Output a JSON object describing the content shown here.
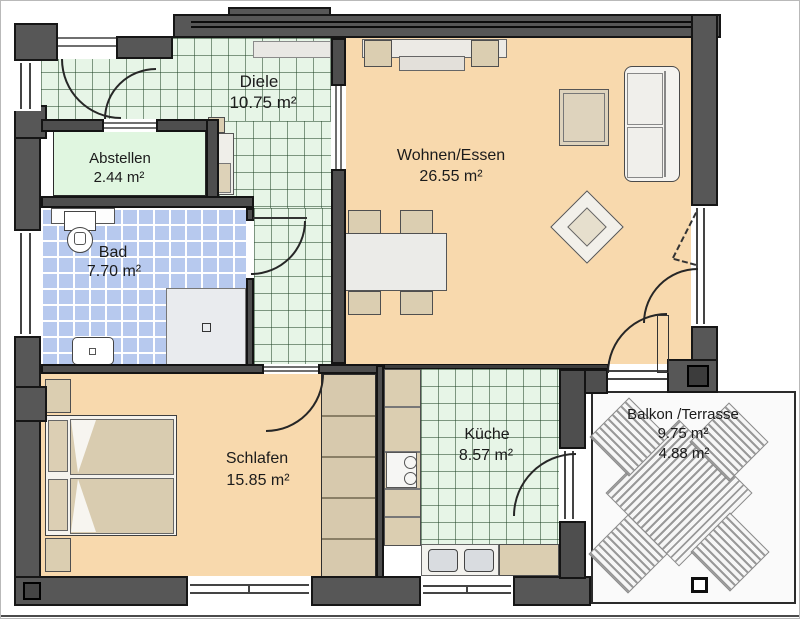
{
  "plan": {
    "rooms": {
      "diele": {
        "name": "Diele",
        "area": "10.75 m²"
      },
      "abstellen": {
        "name": "Abstellen",
        "area": "2.44 m²"
      },
      "bad": {
        "name": "Bad",
        "area": "7.70 m²"
      },
      "wohnen_essen": {
        "name": "Wohnen/Essen",
        "area": "26.55 m²"
      },
      "schlafen": {
        "name": "Schlafen",
        "area": "15.85 m²"
      },
      "kueche": {
        "name": "Küche",
        "area": "8.57 m²"
      },
      "balkon_terrasse": {
        "name": "Balkon /Terrasse",
        "area_gross": "9.75 m²",
        "area_net": "4.88 m²"
      }
    },
    "colors": {
      "wall_exterior": "#575757",
      "wall_interior": "#4e4e4e",
      "floor_tile_hall_kitchen": "#e7f5e7",
      "floor_tile_bath": "#b7c9ee",
      "floor_living_sleeping": "#f8d9ad",
      "floor_storage": "#e0f6e0",
      "balcony_floor": "#fafafa",
      "furniture_wood": "#dbceb1"
    }
  }
}
